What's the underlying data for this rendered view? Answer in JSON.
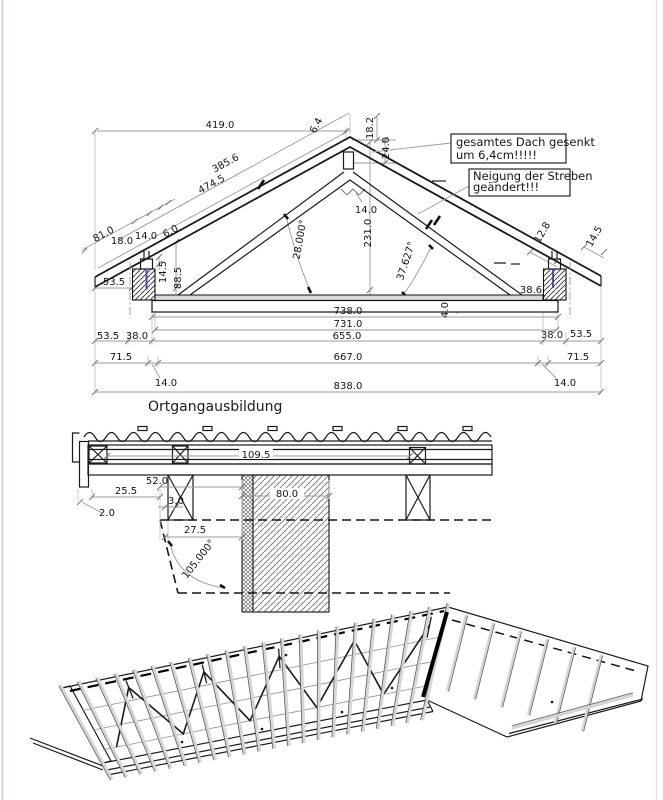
{
  "title_label": "Ortgangausbildung",
  "colors": {
    "dowel_blue": "#4a4ab8",
    "page_edge_left": "#c9d6e8",
    "page_edge_right": "#e2e2e2"
  },
  "notes": {
    "note1_line1": "gesamtes Dach gesenkt",
    "note1_line2": "um  6,4cm!!!!!",
    "note2_line1": "Neigung der Streben",
    "note2_line2": "geändert!!!"
  },
  "truss_dims": {
    "span_top": "419.0",
    "ridge_offset": "6.4",
    "drop_a": "18.2",
    "drop_b": "24.0",
    "rafter_len_a": "385.6",
    "rafter_len_b": "474.5",
    "eave_a": "81.0",
    "eave_b": "18.0",
    "eave_c": "14.0",
    "eave_d": "6.0",
    "left_h1": "53.5",
    "post_h": "14.5",
    "wall_h": "88.5",
    "angle_left": "28.000°",
    "height_center": "231.0",
    "ridge_w": "14.0",
    "angle_right": "37.627°",
    "right_a": "12.8",
    "right_b": "14.5",
    "right_c": "38.6",
    "slab_t": "4.0"
  },
  "truss_chains": {
    "c738": "738.0",
    "c731": "731.0",
    "l535": "53.5",
    "l380": "38.0",
    "c655": "655.0",
    "r380": "38.0",
    "r535": "53.5",
    "l715": "71.5",
    "l140": "14.0",
    "c667": "667.0",
    "r140": "14.0",
    "r715": "71.5",
    "c838": "838.0"
  },
  "detail_dims": {
    "board_len": "109.5",
    "a520": "52.0",
    "a255": "25.5",
    "a30": "3.0",
    "a20": "2.0",
    "a275": "27.5",
    "angle": "105.000°",
    "wall_w": "80.0"
  }
}
